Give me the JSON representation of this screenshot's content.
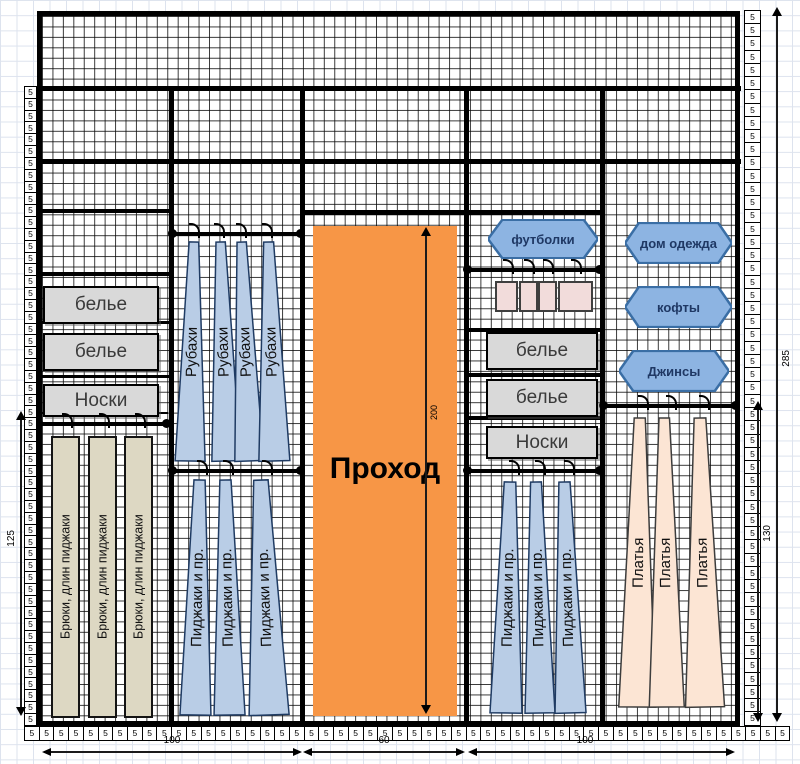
{
  "ruler": {
    "unit": "5",
    "left_count": 54,
    "right_count": 54,
    "bottom_count": 52
  },
  "dims": {
    "left_height": "125",
    "right_total": "285",
    "right_lower": "130",
    "passage_height": "200",
    "bottom_left": "100",
    "bottom_center": "60",
    "bottom_right": "100"
  },
  "passage": {
    "label": "Проход"
  },
  "labels": {
    "underwear": "белье",
    "socks": "Носки",
    "tshirts": "футболки",
    "home_clothes": "дом одежда",
    "sweaters": "кофты",
    "jeans": "Джинсы",
    "shirts": "Рубахи",
    "jackets": "Пиджаки и пр.",
    "trousers": "Брюки, длин пиджаки",
    "dresses": "Платья"
  },
  "colors": {
    "passage_orange": "#F79646",
    "garment_blue": "#B9CDE6",
    "hexagon_blue": "#8DB4E2",
    "trouser_tan": "#DDD8C3",
    "dress_peach": "#FCE5D4",
    "hanging_box_pink": "#F2DCDB",
    "shelf_box_grey": "#D9D9D9"
  }
}
